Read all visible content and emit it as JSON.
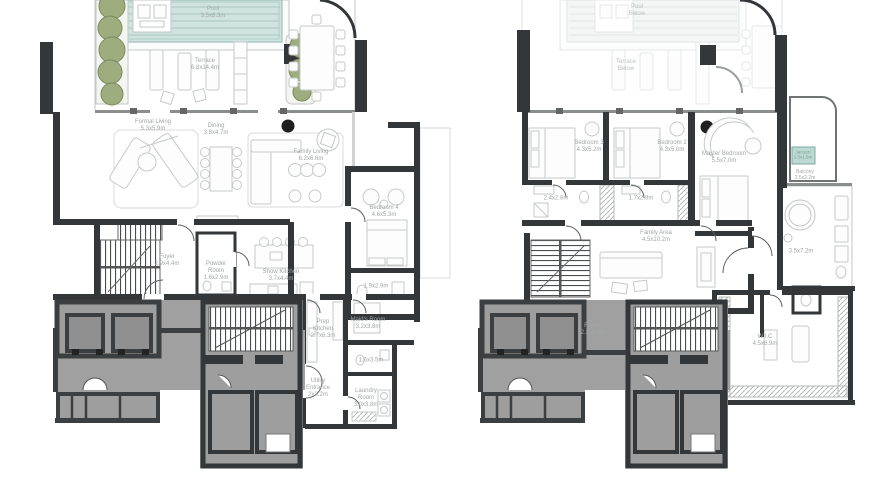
{
  "left_plan": {
    "rooms": {
      "pool": {
        "label": "Pool",
        "dims": "3.5x8.3m"
      },
      "terrace": {
        "label": "Terrace",
        "dims": "6.8x14.4m"
      },
      "formal_living": {
        "label": "Formal Living",
        "dims": "5.3x5.9m"
      },
      "dining": {
        "label": "Dining",
        "dims": "3.8x4.7m"
      },
      "family_living": {
        "label": "Family Living",
        "dims": "6.2x6.6m"
      },
      "bedroom_4": {
        "label": "Bedroom 4",
        "dims": "4.6x5.3m"
      },
      "bedroom_4_bath": {
        "label": "",
        "dims": "1.9x2.9m"
      },
      "foyer": {
        "label": "Foyer",
        "dims": "2.9x4.4m"
      },
      "powder_room": {
        "label": "Powder Room",
        "dims": "1.6x2.9m"
      },
      "show_kitchen": {
        "label": "Show Kitchen",
        "dims": "3.7x4.4m"
      },
      "prep_kitchen": {
        "label": "Prep Kitchen",
        "dims": "2.7x6.3m"
      },
      "maids_room": {
        "label": "Maid's Room",
        "dims": "3.2x3.8m"
      },
      "maids_bath": {
        "label": "",
        "dims": "1.6x3.5m"
      },
      "utility_entrance": {
        "label": "Utility Entrance",
        "dims": "2x3.2m"
      },
      "laundry_room": {
        "label": "Laundry Room",
        "dims": "3.0x3.8m"
      }
    }
  },
  "right_plan": {
    "rooms": {
      "pool_below": {
        "label": "Pool",
        "dims": "Below"
      },
      "terrace_below": {
        "label": "Terrace",
        "dims": "Below"
      },
      "bedroom_3": {
        "label": "Bedroom 3",
        "dims": "4.3x5.2m"
      },
      "bedroom_2": {
        "label": "Bedroom 2",
        "dims": "4.3x5.0m"
      },
      "master_bedroom": {
        "label": "Master Bedroom",
        "dims": "5.5x7.0m"
      },
      "bath_3": {
        "label": "",
        "dims": "2.4x2.8m"
      },
      "bath_2": {
        "label": "",
        "dims": "1.7x2.8m"
      },
      "family_area": {
        "label": "Family Area",
        "dims": "4.5x10.2m"
      },
      "jacuzzi": {
        "label": "Jacuzzi",
        "dims": "1.5x1.5m"
      },
      "balcony": {
        "label": "Balcony",
        "dims": "2.5x2.2m"
      },
      "master_bath": {
        "label": "",
        "dims": "3.5x7.2m"
      },
      "wic": {
        "label": "W.I.C",
        "dims": "4.5x6.9m"
      },
      "family": {
        "label": "Family",
        "dims": "2.2x2.4m"
      }
    }
  },
  "colors": {
    "pool_water": "#cfe3df",
    "wall_dark": "#34373a",
    "core_fill": "#9e9e9e",
    "core_wall": "#3c3f41",
    "plant_green": "#9fac7e",
    "label_gray": "#a2a7a6"
  }
}
